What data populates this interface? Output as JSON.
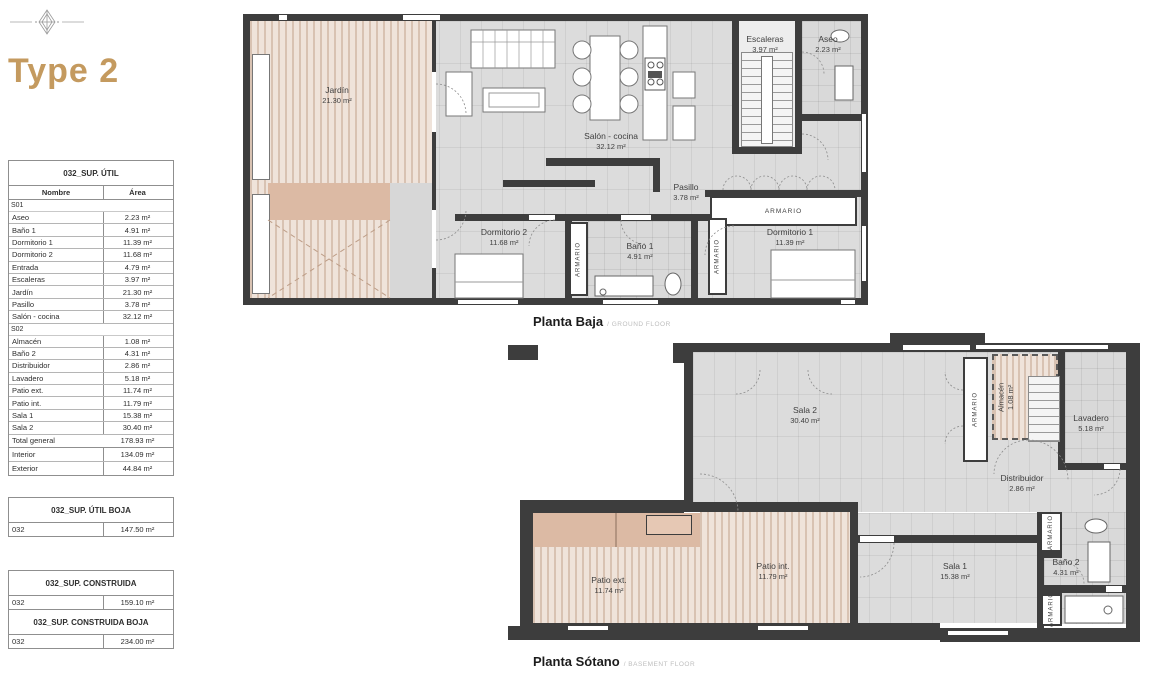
{
  "page": {
    "title": "Type 2",
    "accent_color": "#c49a5f",
    "wall_color": "#3d3d3d"
  },
  "tables": {
    "sup_util": {
      "title": "032_SUP. ÚTIL",
      "col_name": "Nombre",
      "col_area": "Área",
      "section1_label": "S01",
      "section1_rows": [
        {
          "name": "Aseo",
          "area": "2.23 m²"
        },
        {
          "name": "Baño 1",
          "area": "4.91 m²"
        },
        {
          "name": "Dormitorio 1",
          "area": "11.39 m²"
        },
        {
          "name": "Dormitorio 2",
          "area": "11.68 m²"
        },
        {
          "name": "Entrada",
          "area": "4.79 m²"
        },
        {
          "name": "Escaleras",
          "area": "3.97 m²"
        },
        {
          "name": "Jardín",
          "area": "21.30 m²"
        },
        {
          "name": "Pasillo",
          "area": "3.78 m²"
        },
        {
          "name": "Salón - cocina",
          "area": "32.12 m²"
        }
      ],
      "section2_label": "S02",
      "section2_rows": [
        {
          "name": "Almacén",
          "area": "1.08 m²"
        },
        {
          "name": "Baño 2",
          "area": "4.31 m²"
        },
        {
          "name": "Distribuidor",
          "area": "2.86 m²"
        },
        {
          "name": "Lavadero",
          "area": "5.18 m²"
        },
        {
          "name": "Patio ext.",
          "area": "11.74 m²"
        },
        {
          "name": "Patio int.",
          "area": "11.79 m²"
        },
        {
          "name": "Sala 1",
          "area": "15.38 m²"
        },
        {
          "name": "Sala 2",
          "area": "30.40 m²"
        }
      ],
      "total_label": "Total general",
      "total_value": "178.93 m²",
      "interior_label": "Interior",
      "interior_value": "134.09 m²",
      "exterior_label": "Exterior",
      "exterior_value": "44.84 m²"
    },
    "sup_util_boja": {
      "title": "032_SUP. ÚTIL BOJA",
      "code": "032",
      "value": "147.50 m²"
    },
    "sup_construida": {
      "title": "032_SUP. CONSTRUIDA",
      "code": "032",
      "value": "159.10 m²"
    },
    "sup_construida_boja": {
      "title": "032_SUP. CONSTRUIDA BOJA",
      "code": "032",
      "value": "234.00 m²"
    }
  },
  "ground": {
    "caption": "Planta Baja",
    "caption_sub": "/ GROUND FLOOR",
    "armario": "ARMARIO",
    "rooms": {
      "jardin": {
        "name": "Jardín",
        "area": "21.30 m²"
      },
      "salon": {
        "name": "Salón - cocina",
        "area": "32.12 m²"
      },
      "escaleras": {
        "name": "Escaleras",
        "area": "3.97 m²"
      },
      "aseo": {
        "name": "Aseo",
        "area": "2.23 m²"
      },
      "pasillo": {
        "name": "Pasillo",
        "area": "3.78 m²"
      },
      "dormitorio2": {
        "name": "Dormitorio 2",
        "area": "11.68 m²"
      },
      "bano1": {
        "name": "Baño 1",
        "area": "4.91 m²"
      },
      "dormitorio1": {
        "name": "Dormitorio 1",
        "area": "11.39 m²"
      }
    }
  },
  "basement": {
    "caption": "Planta Sótano",
    "caption_sub": "/ BASEMENT FLOOR",
    "armario": "ARMARIO",
    "rooms": {
      "sala2": {
        "name": "Sala 2",
        "area": "30.40 m²"
      },
      "almacen": {
        "name": "Almacén",
        "area": "1.08 m²"
      },
      "lavadero": {
        "name": "Lavadero",
        "area": "5.18 m²"
      },
      "distribuidor": {
        "name": "Distribuidor",
        "area": "2.86 m²"
      },
      "sala1": {
        "name": "Sala 1",
        "area": "15.38 m²"
      },
      "bano2": {
        "name": "Baño 2",
        "area": "4.31 m²"
      },
      "patio_ext": {
        "name": "Patio ext.",
        "area": "11.74 m²"
      },
      "patio_int": {
        "name": "Patio int.",
        "area": "11.79 m²"
      }
    }
  }
}
